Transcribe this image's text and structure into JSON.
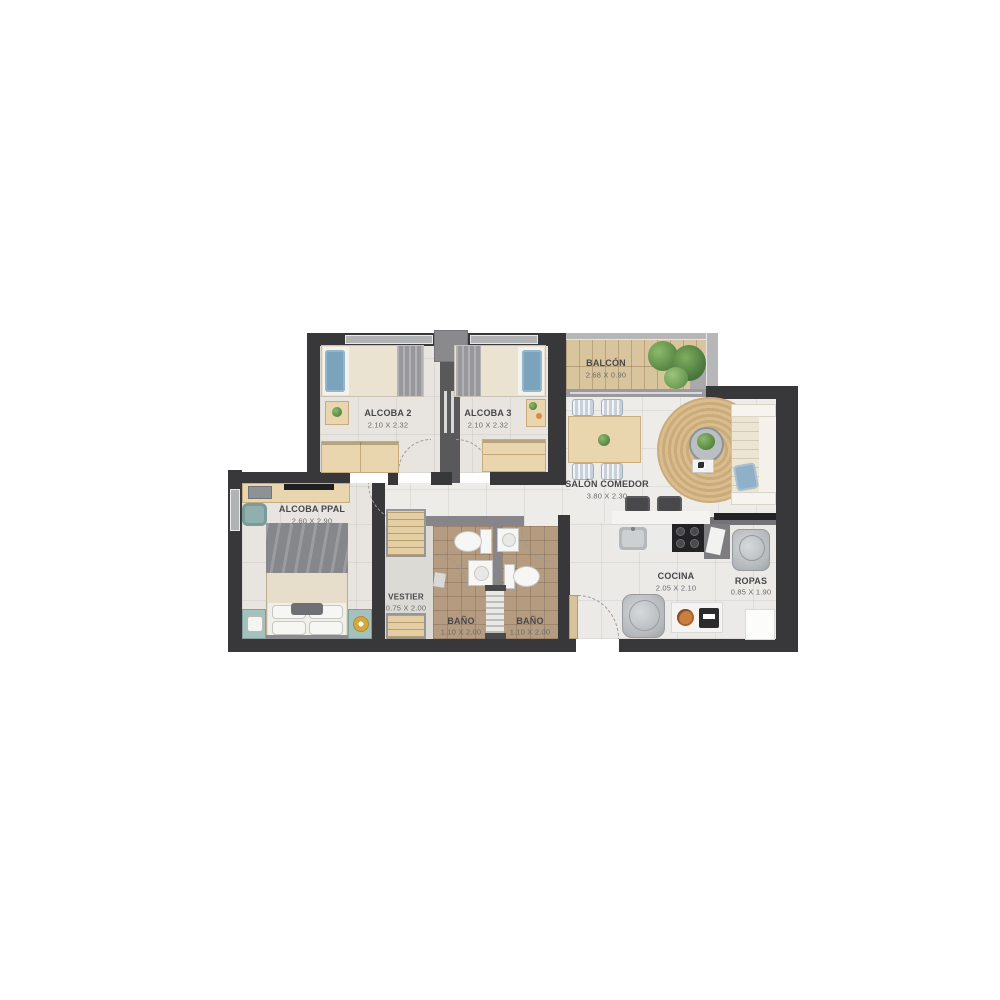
{
  "plan": {
    "type": "apartment-floor-plan",
    "rooms": [
      {
        "id": "balcon",
        "name": "BALCÓN",
        "dims": "2.68 X 0.90"
      },
      {
        "id": "alcoba2",
        "name": "ALCOBA 2",
        "dims": "2.10 X 2.32"
      },
      {
        "id": "alcoba3",
        "name": "ALCOBA 3",
        "dims": "2.10 X 2.32"
      },
      {
        "id": "salon",
        "name": "SALÓN COMEDOR",
        "dims": "3.80 X 2.30"
      },
      {
        "id": "alcoba_ppal",
        "name": "ALCOBA PPAL",
        "dims": "2.60 X 2.90"
      },
      {
        "id": "vestier",
        "name": "VESTIER",
        "dims": "0.75 X 2.00"
      },
      {
        "id": "bano1",
        "name": "BAÑO",
        "dims": "1.10 X 2.00"
      },
      {
        "id": "bano2",
        "name": "BAÑO",
        "dims": "1.10 X 2.00"
      },
      {
        "id": "cocina",
        "name": "COCINA",
        "dims": "2.05 X 2.10"
      },
      {
        "id": "ropas",
        "name": "ROPAS",
        "dims": "0.85 X 1.90"
      }
    ],
    "colors": {
      "wall_dark": "#38383a",
      "wall_gray": "#85858a",
      "floor": "#e8e5e0",
      "bath_tile": "#b59b80",
      "balcony_deck": "#d8c59e",
      "furniture_wood": "#e9d6ae",
      "teal_accent": "#a5c1be",
      "pillow_blue": "#7ba3bc",
      "rug_jute": "#d3b584",
      "label_text": "#47474a",
      "dim_text": "#6a6a6d"
    }
  }
}
